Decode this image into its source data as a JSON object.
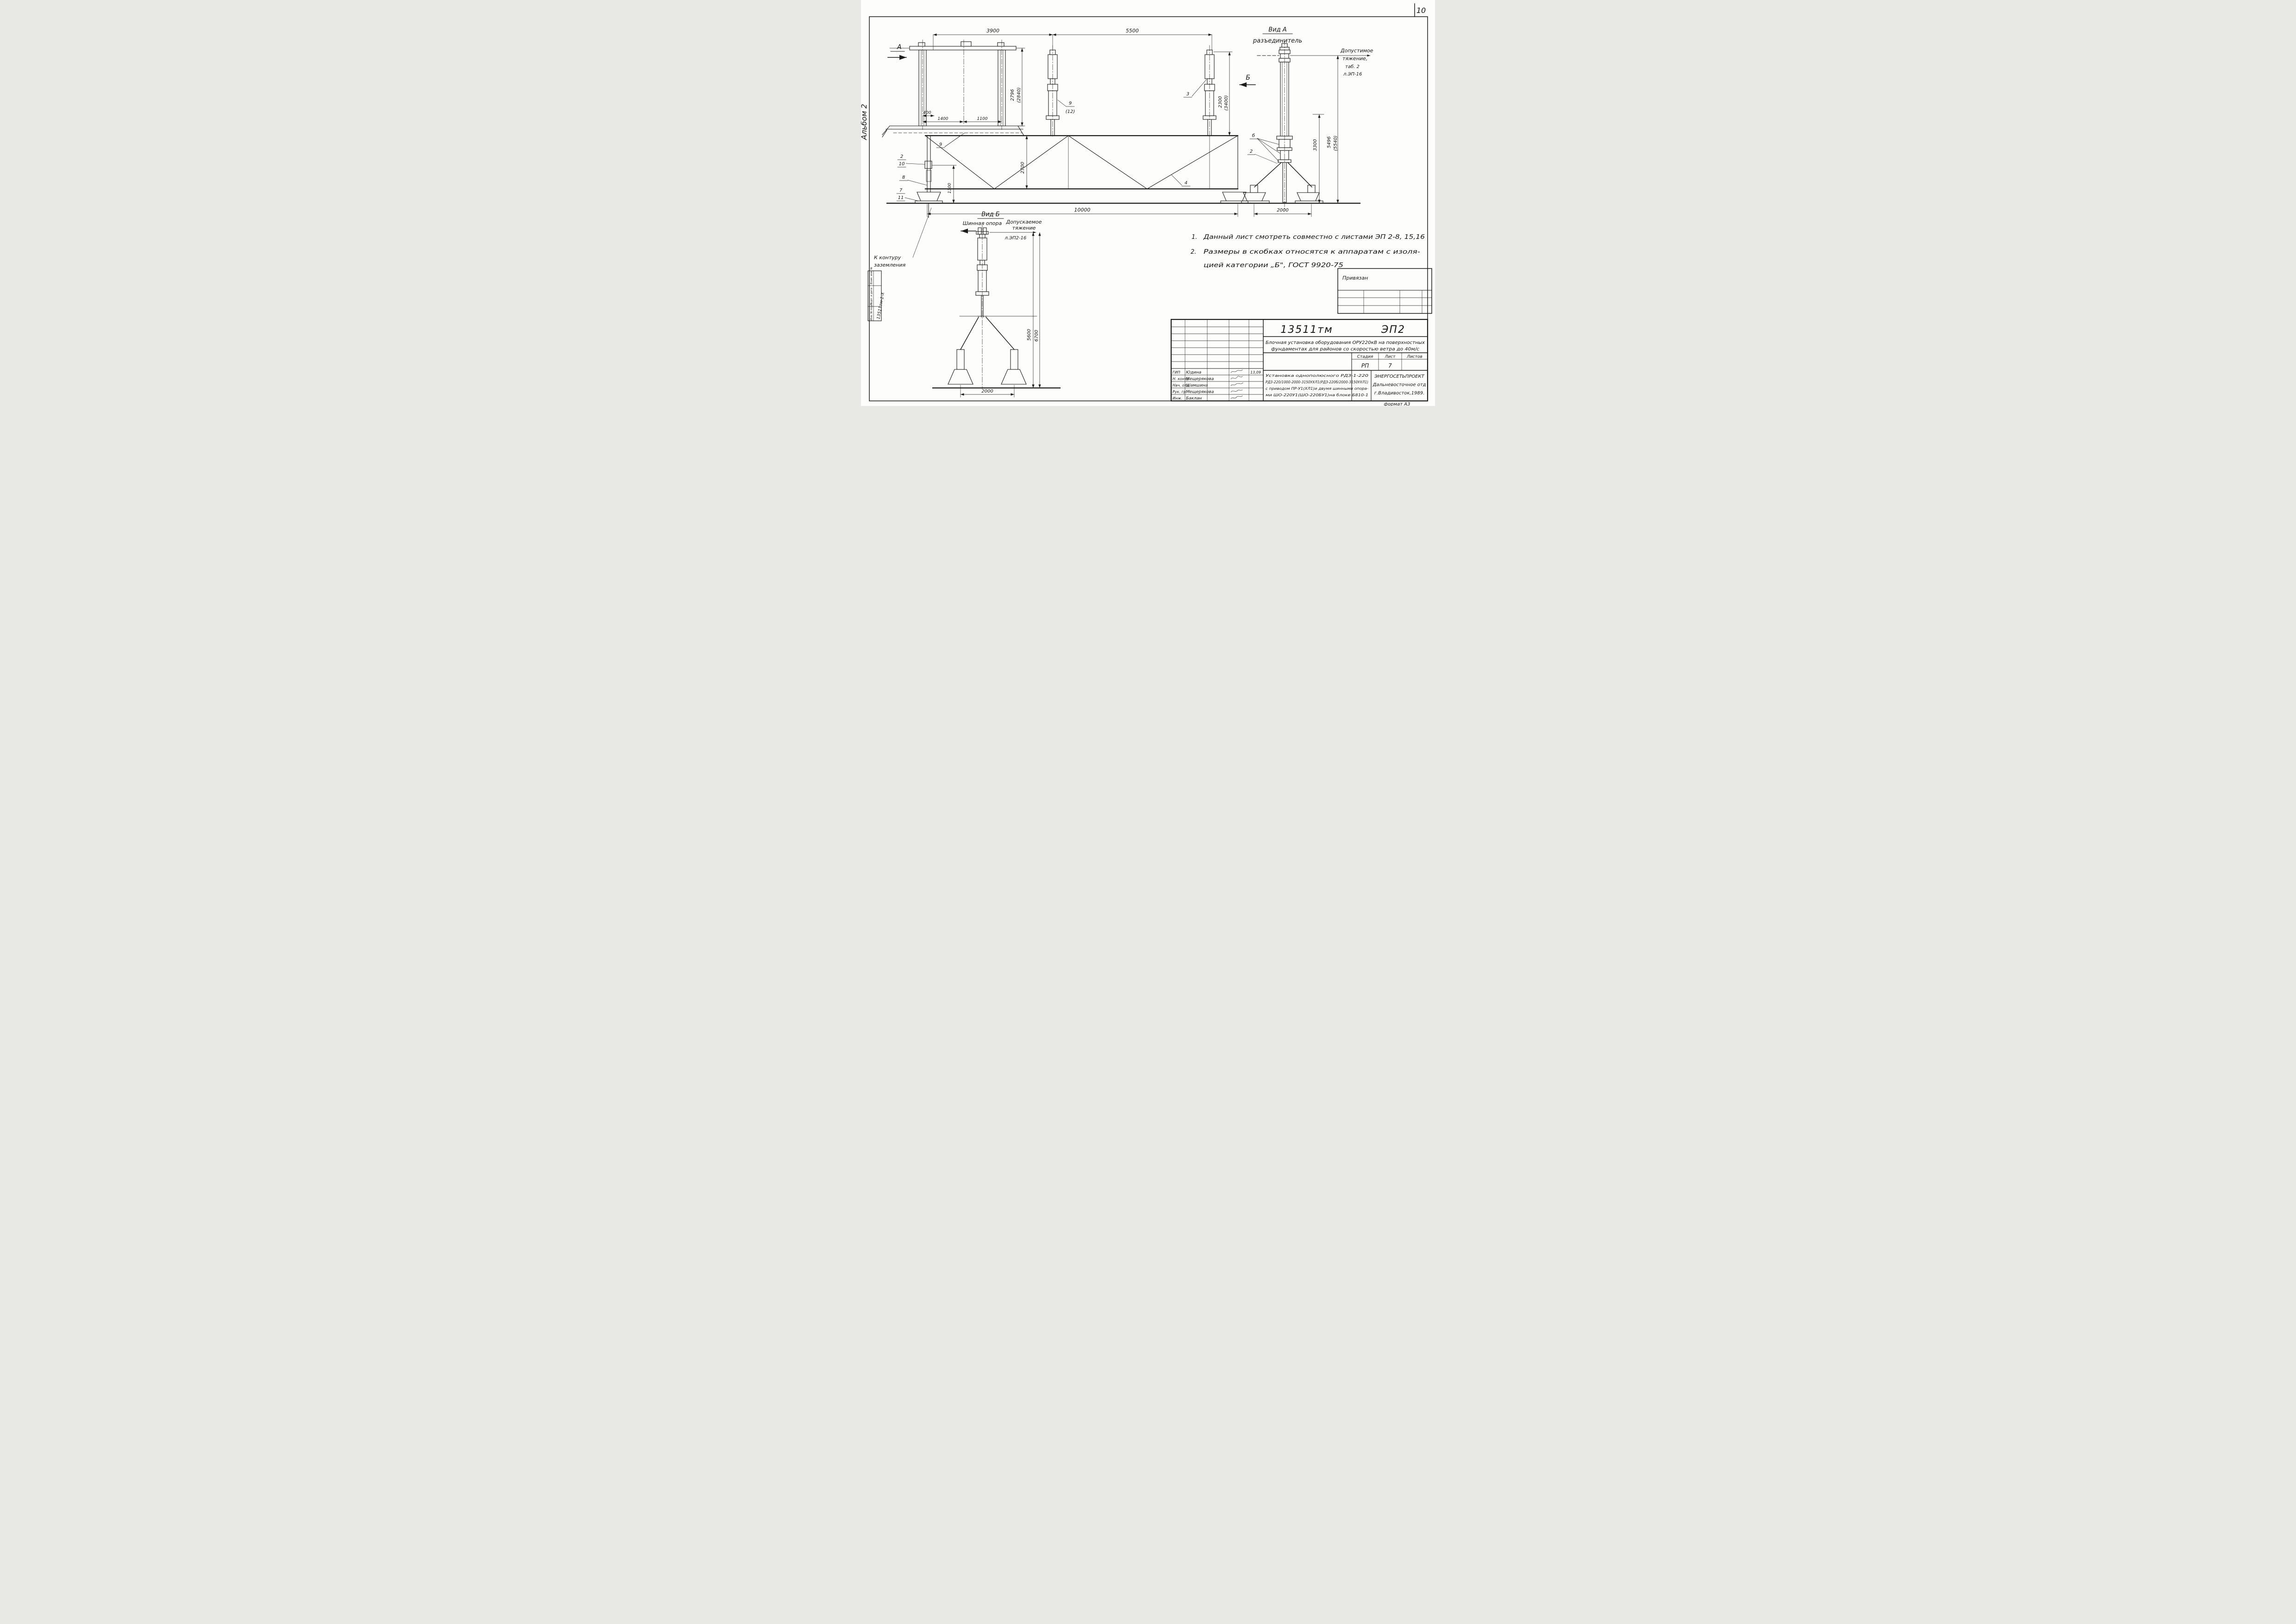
{
  "page": {
    "number": "10",
    "album_label": "Альбом 2",
    "format_label": "формат А3"
  },
  "frame_stamp": {
    "top": "Взам. инв. №",
    "middle": "Подп. и дата",
    "bottom": "Инв. № подл.",
    "inventory_code": "13511тм-1-Х"
  },
  "view_main": {
    "section_a": "А",
    "section_b": "Б",
    "note_9": "9",
    "note_9b": "9",
    "note_12": "(12)",
    "note_3": "3",
    "note_4": "4",
    "note_2": "2",
    "note_10": "10",
    "note_8": "8",
    "note_7": "7",
    "note_11": "11",
    "grounding_1": "К контуру",
    "grounding_2": "заземления"
  },
  "view_a": {
    "title": "Вид А",
    "subtitle": "разъединитель",
    "note_b": "б",
    "note_2": "2",
    "tension_1": "Допустимое",
    "tension_2": "тяжение,",
    "tension_3": "таб. 2",
    "tension_4": "л.ЭП-16"
  },
  "view_b": {
    "title": "Вид Б",
    "subtitle": "Шинная опора",
    "tension_1": "Допускаемое",
    "tension_2": "тяжение",
    "ref": "л.ЭП2-16"
  },
  "dims": {
    "d3900": "3900",
    "d5500": "5500",
    "d400": "400",
    "d1400": "1400",
    "d1100": "1100",
    "d2796": "2796",
    "d2796_alt": "(2840)",
    "d2300": "2300",
    "d2300_alt": "(3400)",
    "d2700": "2700",
    "d1300": "1300",
    "d3300": "3300",
    "d10000": "10000",
    "d5496": "5496",
    "d5496_alt": "(5540)",
    "d2000": "2000",
    "d5600": "5600",
    "d6700": "6700",
    "d2000_b": "2000"
  },
  "notes": {
    "n1_num": "1.",
    "n1": "Данный лист смотреть совместно с листами ЭП 2-8, 15,16",
    "n2_num": "2.",
    "n2a": "Размеры в скобках относятся к аппаратам с изоля-",
    "n2b": "цией категории „Б\", ГОСТ 9920-75"
  },
  "privyazan_table": {
    "title": "Привязан"
  },
  "title_block": {
    "doc_code": "13511тм",
    "sheet_code": "ЭП2",
    "title_1": "Блочная установка оборудования ОРУ220кВ на поверхностных",
    "title_2": "фундаментах для районов со скоростью ветра до 40м/с",
    "stage_header": "Стадия",
    "sheet_header": "Лист",
    "sheets_header": "Листов",
    "stage": "РП",
    "sheet_no": "7",
    "desc_1": "Установка однополюсного РДЗ-1-220",
    "desc_2": "РДЗ-220/1000-2000-3150УХЛ1(РДЗ-220б/2000-3150УХЛ1)",
    "desc_3": "с приводом ПР-У1(ХЛ1)и двумя шинными опора-",
    "desc_4": "ми ШО-220У1(ШО-220БУ1)на блоке Б810-1",
    "org_1": "ЭНЕРГОСЕТЬПРОЕКТ",
    "org_2": "Дальневосточное отд",
    "org_3": "г.Владивосток,1989.",
    "signatures": [
      {
        "role": "ГИП",
        "name": "Юдина",
        "date": "13,09"
      },
      {
        "role": "Н. контр",
        "name": "Мещерякова",
        "date": ""
      },
      {
        "role": "Нач. отд",
        "name": "Шамшина",
        "date": ""
      },
      {
        "role": "Рук. гр.",
        "name": "Мещерякова",
        "date": ""
      },
      {
        "role": "Инж.",
        "name": "Баклан",
        "date": ""
      }
    ]
  }
}
